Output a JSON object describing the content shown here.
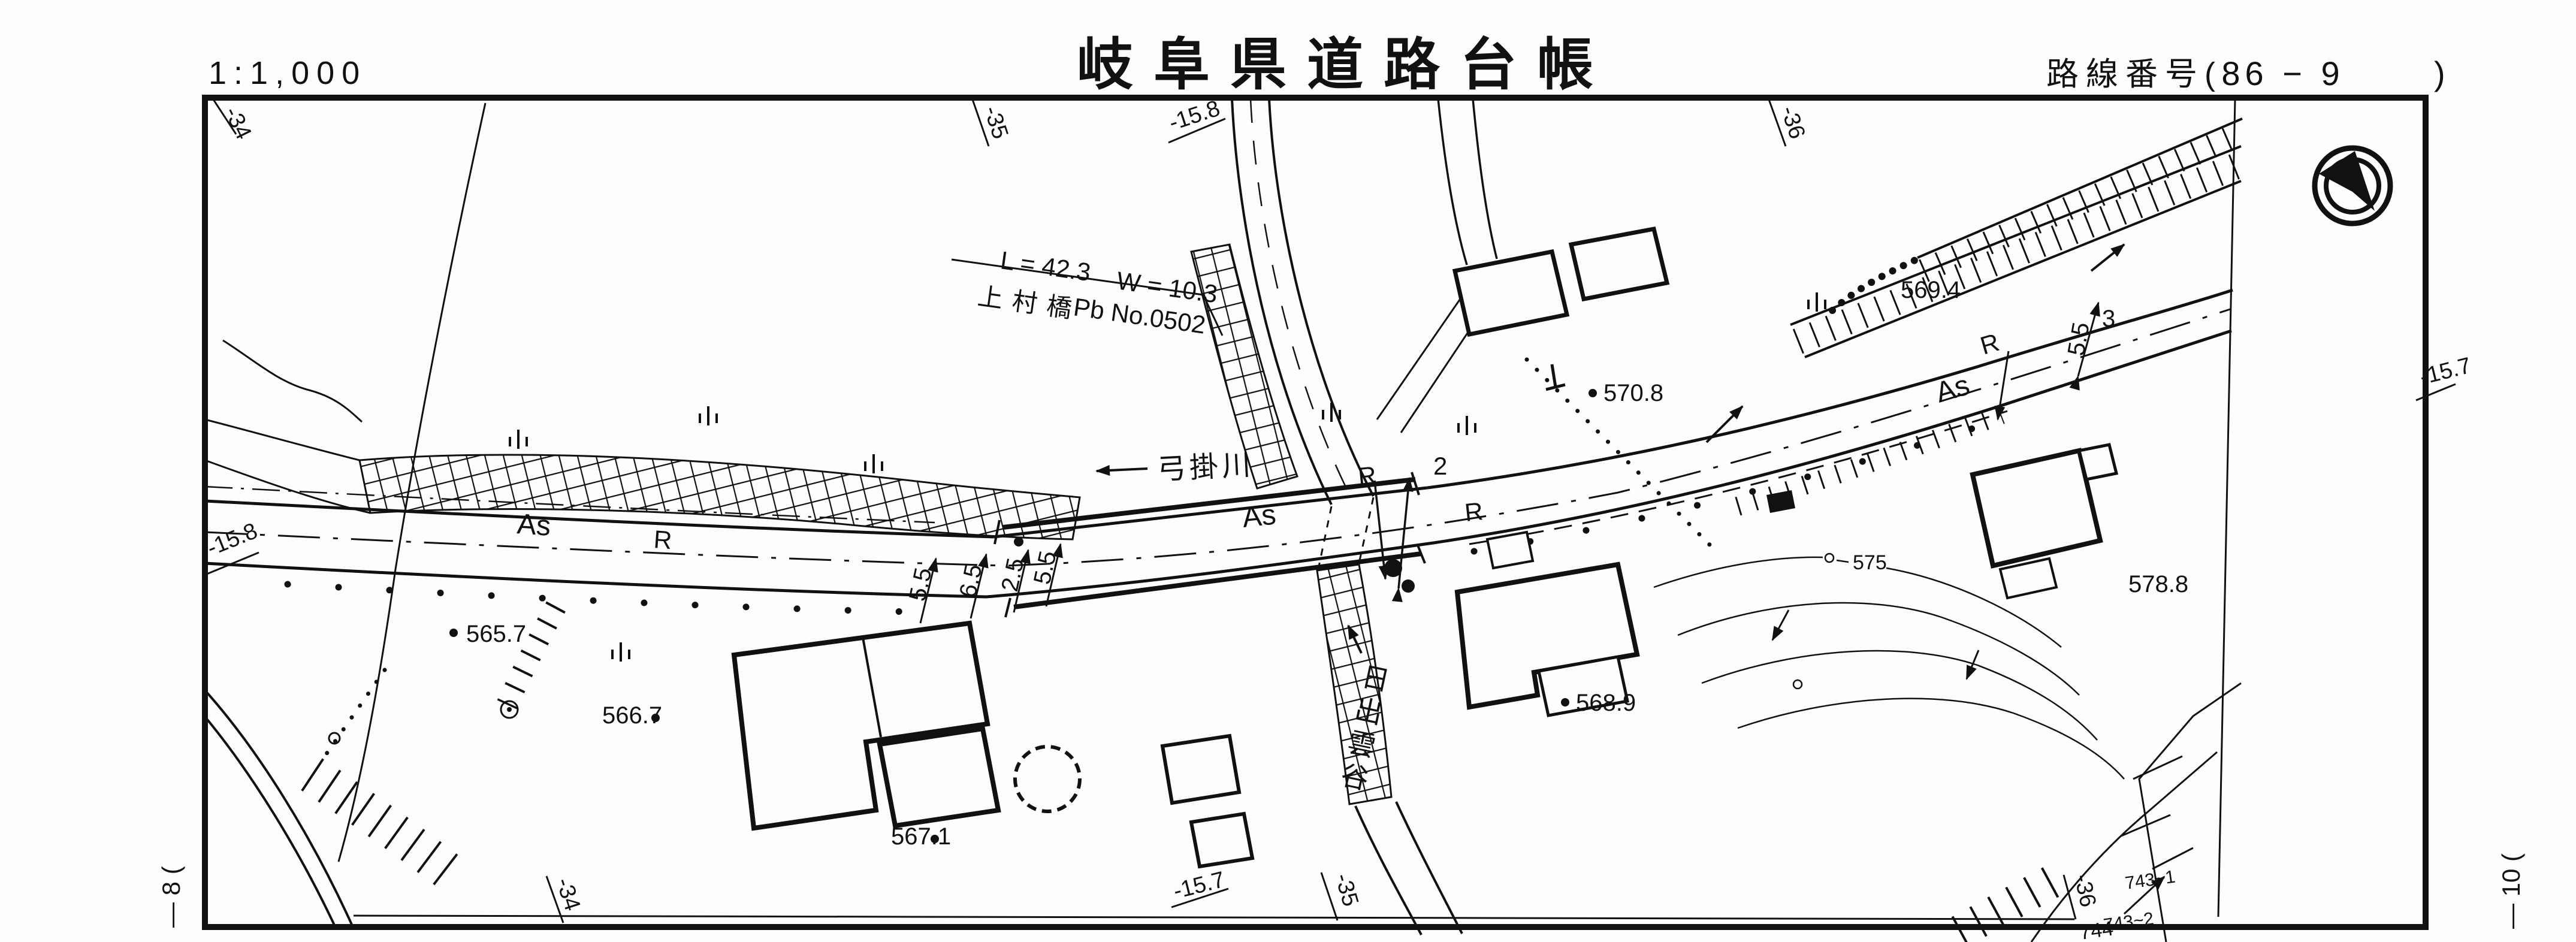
{
  "header": {
    "scale": "1:1,000",
    "title": "岐阜県道路台帳",
    "route_prefix": "路線番号(",
    "route_number": "86 − 9",
    "route_suffix": ")"
  },
  "sheet_edges": {
    "left_sheet_label": "— 8 (",
    "right_sheet_label": "— 10 ("
  },
  "grid": {
    "top_34": "-34",
    "top_35": "-35",
    "top_158": "-15.8",
    "top_36": "-36",
    "left_158": "-15.8",
    "right_157": "-15.7",
    "bottom_34": "-34",
    "bottom_157": "-15.7",
    "bottom_35": "-35",
    "bottom_36": "-36"
  },
  "bridge": {
    "length": "L = 42.3",
    "width": "W = 10.3",
    "name": "上村橋",
    "pier_no": "Pb No.0502"
  },
  "river": {
    "name": "弓掛川"
  },
  "valley": {
    "name": "日出雲谷"
  },
  "elevations": {
    "e5657": "565.7",
    "e5667": "566.7",
    "e5671": "567.1",
    "e5689": "568.9",
    "e5708": "570.8",
    "e5694": "569.4",
    "e5788": "578.8"
  },
  "contours": {
    "c575": "575"
  },
  "road": {
    "as1": "As",
    "as2": "As",
    "as3": "As",
    "r1": "R",
    "r2": "R",
    "r3": "R",
    "r4": "R",
    "lane2": "2",
    "w55a": "5.5",
    "w65": "6.5",
    "w25": "2.5",
    "w55b": "5.5",
    "w55c": "5.5",
    "w3": "3"
  },
  "parcels": {
    "p743_1": "743~1",
    "p743_2": "743~2",
    "p744": "744"
  }
}
